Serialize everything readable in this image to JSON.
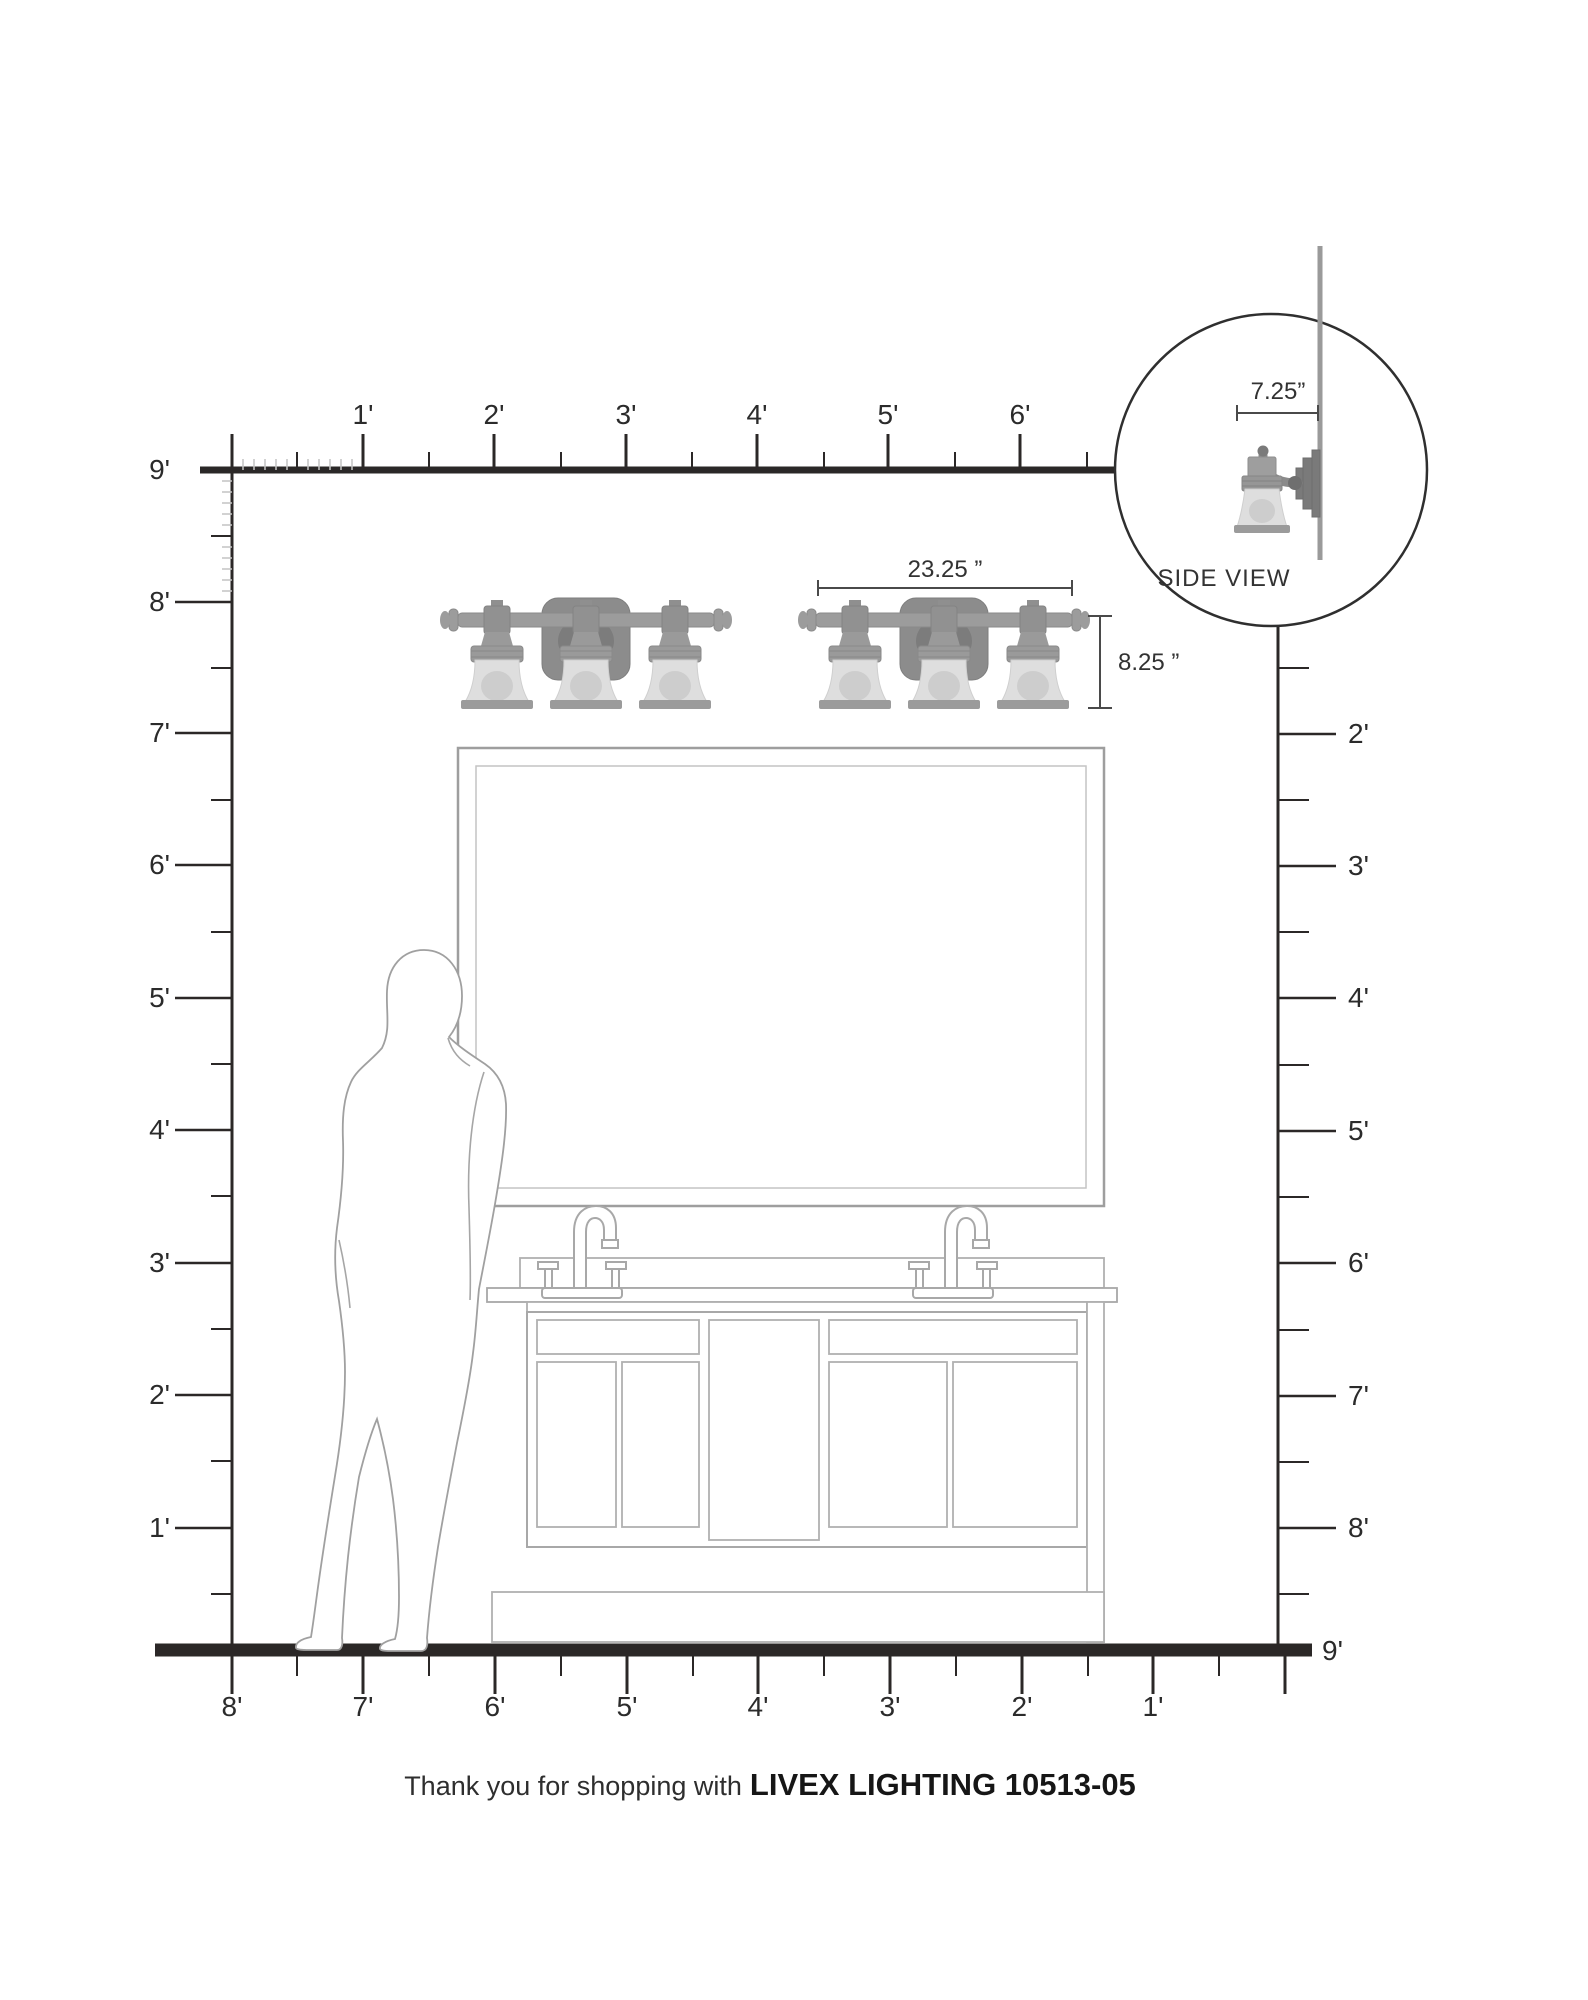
{
  "title": "Livex Lighting vanity light scale diagram",
  "rulers": {
    "top": {
      "labels": [
        "1'",
        "2'",
        "3'",
        "4'",
        "5'",
        "6'"
      ]
    },
    "left": {
      "labels": [
        "9'",
        "8'",
        "7'",
        "6'",
        "5'",
        "4'",
        "3'",
        "2'",
        "1'"
      ]
    },
    "right": {
      "labels": [
        "2'",
        "3'",
        "4'",
        "5'",
        "6'",
        "7'",
        "8'"
      ]
    },
    "bottom": {
      "labels": [
        "8'",
        "7'",
        "6'",
        "5'",
        "4'",
        "3'",
        "2'",
        "1'"
      ],
      "end_label": "9'"
    }
  },
  "dimensions": {
    "fixture_width": "23.25 ”",
    "fixture_height": "8.25 ”",
    "fixture_depth": "7.25”"
  },
  "inset": {
    "caption": "SIDE VIEW"
  },
  "footer": {
    "prefix": "Thank you for shopping with",
    "product": "LIVEX LIGHTING 10513-05"
  },
  "colors": {
    "ink": "#2b2b2b",
    "ruler_minor_tick": "#c4c4c4",
    "drawing_outline": "#a8a8a8",
    "drawing_outline_light": "#bfbfbf",
    "fixture_metal": "#9c9c9c",
    "fixture_dark": "#8a8a8a",
    "glass": "#dedede",
    "glass_bulb": "#cdcdcd",
    "wall_line": "#9a9a9a"
  }
}
